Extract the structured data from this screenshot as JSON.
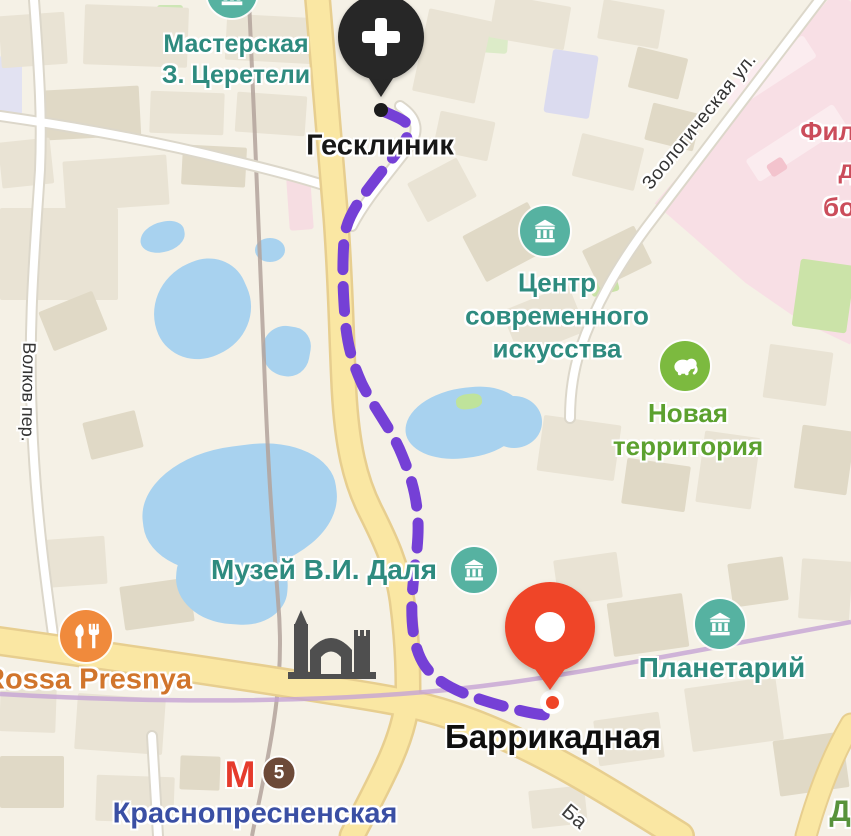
{
  "app": "yandex-maps-route-view",
  "route": {
    "style": "dashed",
    "from": "Гесклиник",
    "to": "Баррикадная"
  },
  "pins": {
    "origin": {
      "label": "Гесклиник",
      "icon": "medical-cross",
      "color": "#272727"
    },
    "destination": {
      "label": "Баррикадная",
      "color": "#EF4528"
    }
  },
  "pois": {
    "workshop": {
      "line1": "Мастерская",
      "line2": "З. Церетели",
      "icon": "museum-icon"
    },
    "art_center": {
      "line1": "Центр",
      "line2": "современного",
      "line3": "искусства",
      "icon": "museum-icon"
    },
    "new_territory": {
      "line1": "Новая",
      "line2": "территория",
      "icon": "elephant-icon"
    },
    "dal_museum": {
      "label": "Музей В.И. Даля",
      "icon": "museum-icon"
    },
    "planetarium": {
      "label": "Планетарий",
      "icon": "museum-icon"
    },
    "rossa": {
      "label": "Rossa Presnya",
      "icon": "restaurant-icon"
    }
  },
  "streets": {
    "zoologicheskaya": "Зоологическая ул.",
    "volkov": "Волков пер.",
    "ba_fragment": "Ба"
  },
  "fragments": {
    "hospital_line1": "Фил",
    "hospital_line2": "д",
    "hospital_line3": "бо",
    "green_d": "Д"
  },
  "metro": {
    "logo": "М",
    "line_number": "5",
    "station": "Краснопресненская"
  },
  "colors": {
    "route-purple": "#7540D6",
    "pin-red": "#EF4528",
    "pin-black": "#272727",
    "teal": "#2E8B7F",
    "teal-icon": "#56B2A1",
    "zoo-green": "#5CA12F",
    "zoo-icon": "#7CBA3F",
    "food-icon": "#F08A3C",
    "orange-text": "#D1752C",
    "metro-red": "#E53B2C",
    "badge-brown": "#6D4A38",
    "metro-navy": "#3A4FA4",
    "hospital-red": "#CB4D5B",
    "water": "#A8D2EF",
    "road-yellow": "#FAE7A3",
    "pink-zone": "#F8DFE5"
  }
}
